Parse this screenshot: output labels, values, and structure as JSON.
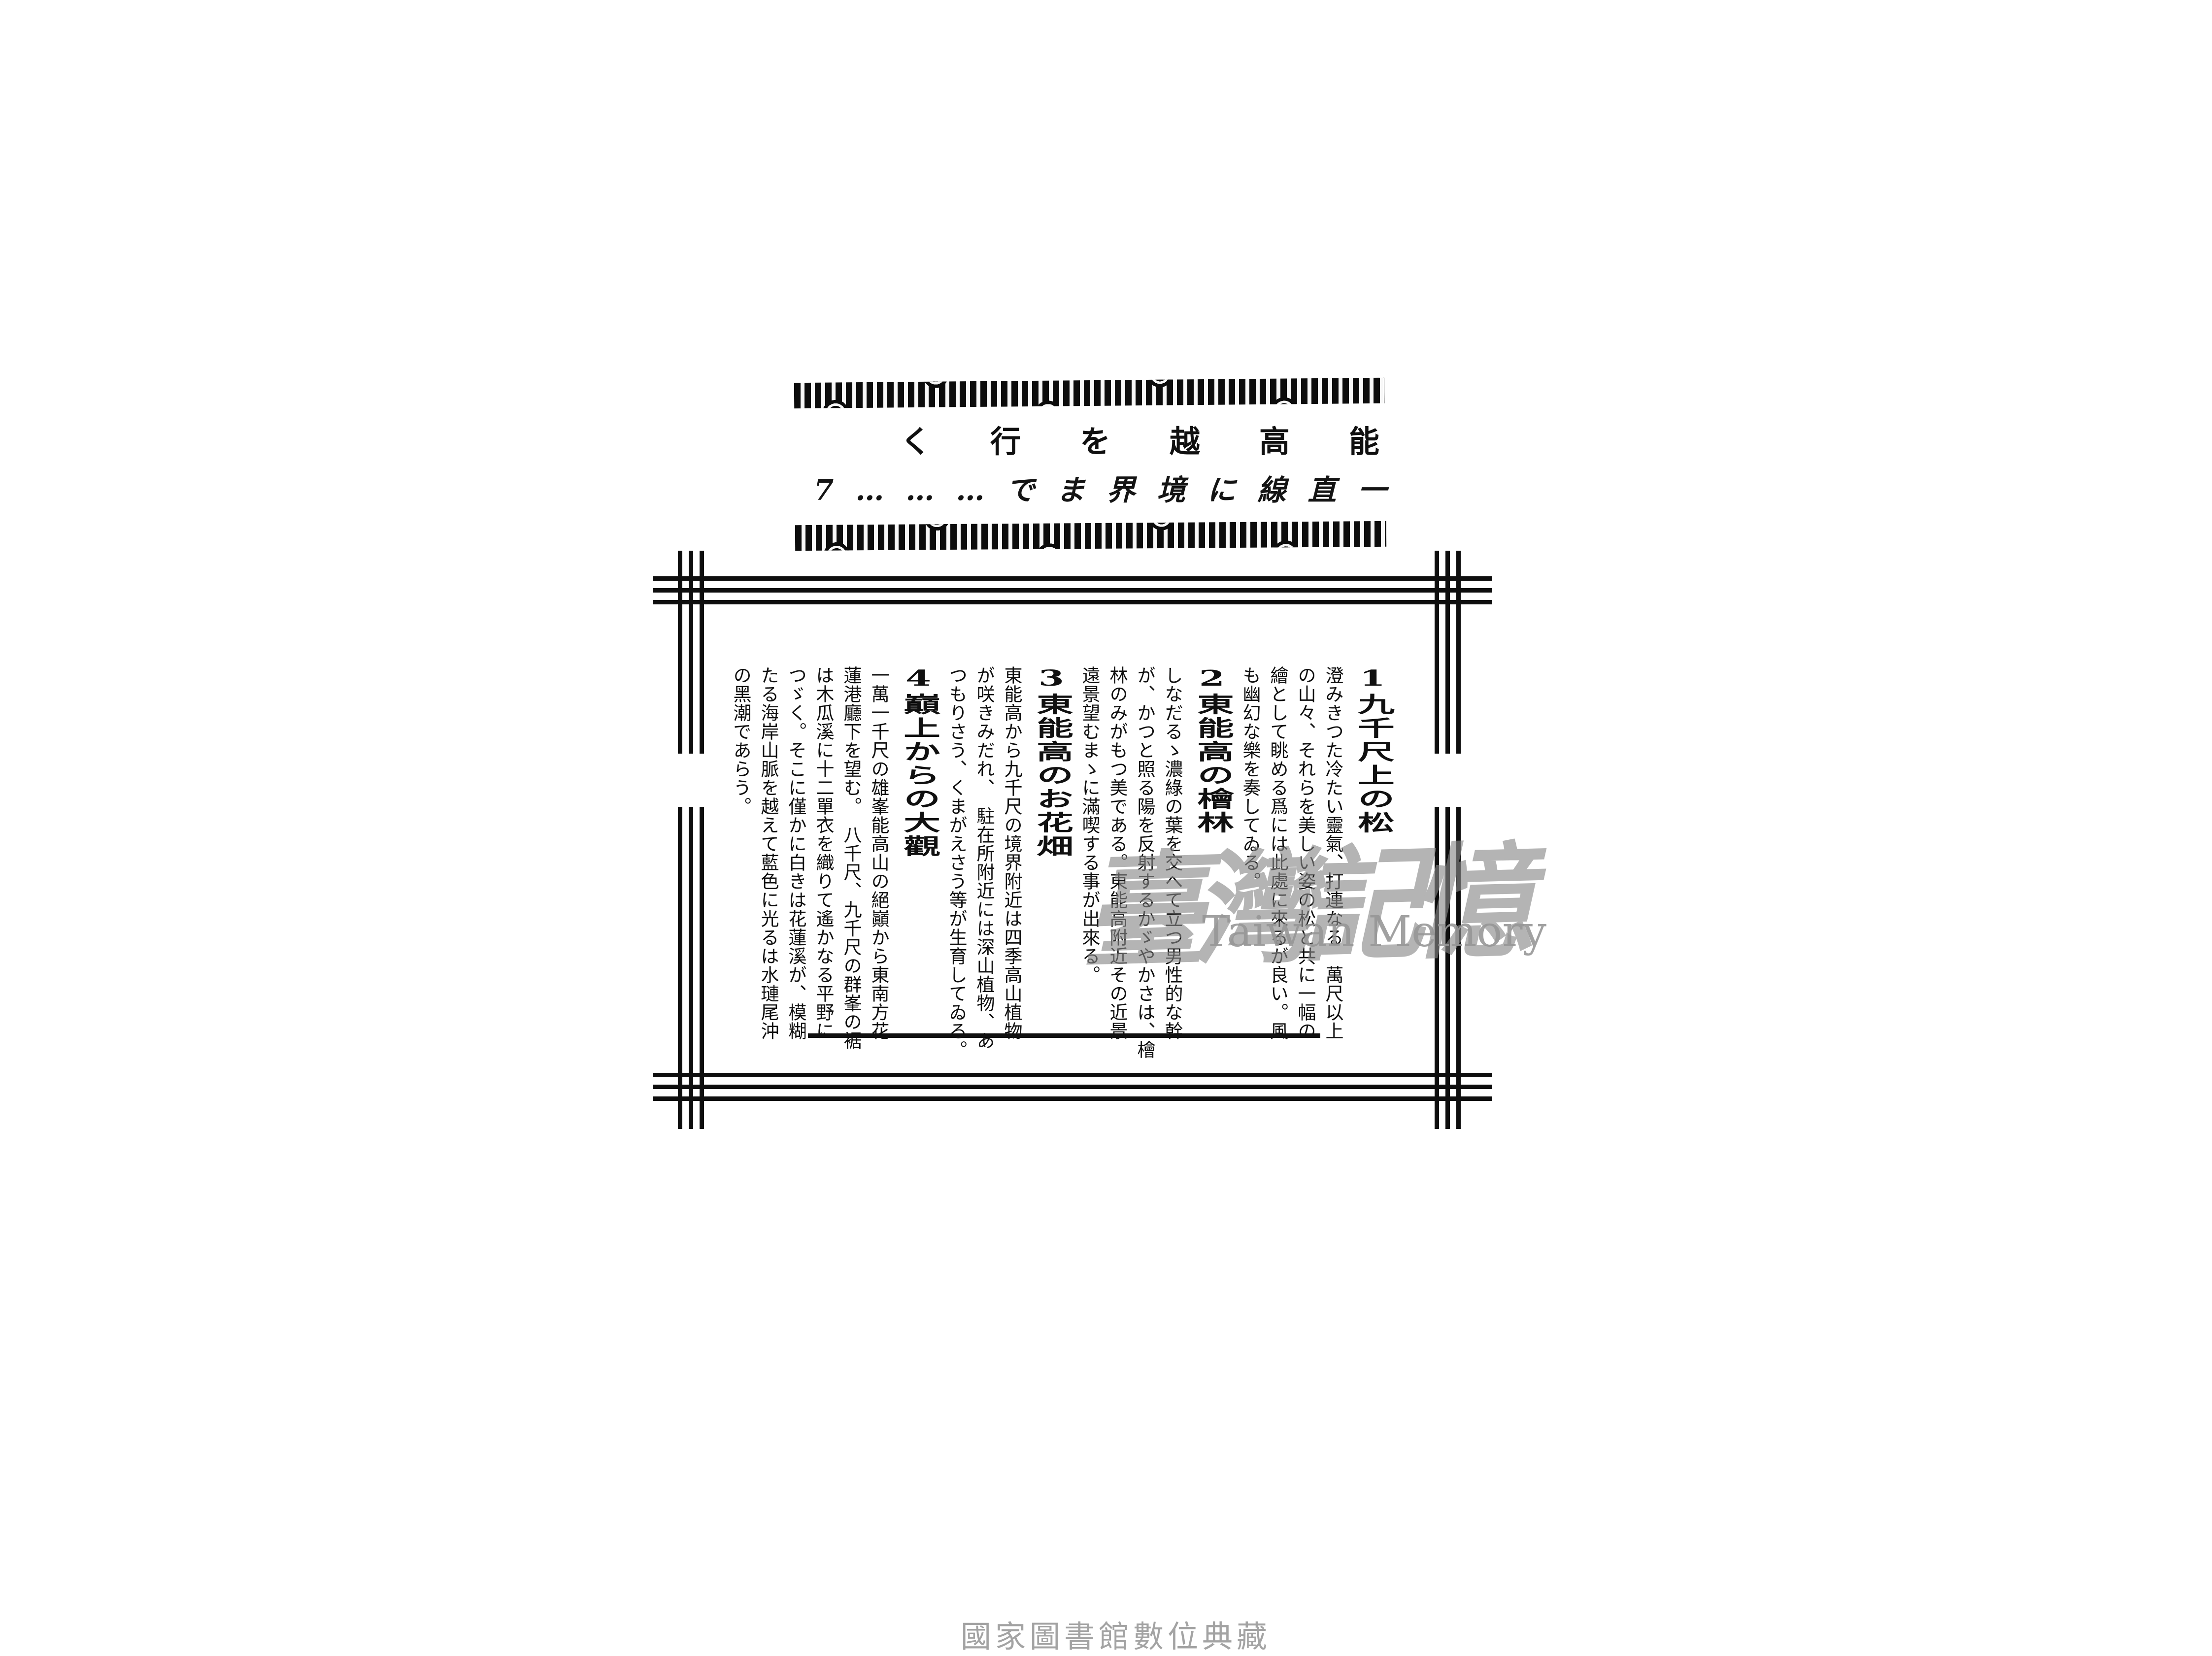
{
  "colors": {
    "ink": "#101010",
    "paper": "#ffffff",
    "watermark_grey": "#8e8e8e",
    "footer_grey": "#a3a3a3"
  },
  "banner": {
    "title_display": "く行を越高能",
    "subtitle_display": "7………でま界境に線直一"
  },
  "article": {
    "sections": [
      {
        "num": "1",
        "title": "九千尺上の松",
        "columns": [
          "澄みきつた冷たい靈氣、打連なる　萬尺以上",
          "の山々、それらを美しい姿の松と共に一幅の",
          "繪として眺める爲には此處に來るが良い。風",
          "も幽幻な樂を奏してゐる。"
        ]
      },
      {
        "num": "2",
        "title": "東能高の檜林",
        "columns": [
          "しなだるゝ濃綠の葉を交へて立つ男性的な幹",
          "が、かつと照る陽を反射するかゞやかさは、檜",
          "林のみがもつ美である。東能高附近その近景",
          "遠景望むまゝに滿喫する事が出來る。"
        ]
      },
      {
        "num": "3",
        "title": "東能高のお花畑",
        "columns": [
          "東能高から九千尺の境界附近は四季高山植物",
          "が咲きみだれ、　駐在所附近には深山植物、あ",
          "つもりさう、くまがえさう等が生育してゐる。"
        ]
      },
      {
        "num": "4",
        "title": "巔上からの大觀",
        "columns": [
          "一萬一千尺の雄峯能高山の絕巓から東南方花",
          "蓮港廳下を望む。　八千尺、九千尺の群峯の裾",
          "は木瓜溪に十二單衣を織りて遙かなる平野に",
          "つゞく。そこに僅かに白きは花蓮溪が、模糊",
          "たる海岸山脈を越えて藍色に光るは水璉尾沖",
          "の黑潮であらう。"
        ]
      }
    ]
  },
  "watermark": {
    "cjk": "臺灣記憶",
    "latin": "Taiwan Memory"
  },
  "footer": {
    "text": "國家圖書館數位典藏"
  }
}
